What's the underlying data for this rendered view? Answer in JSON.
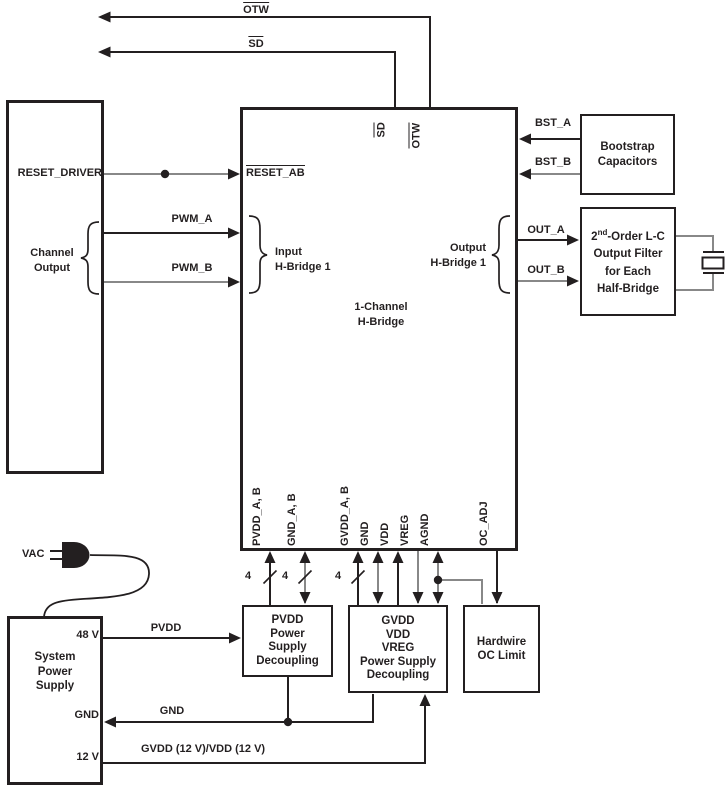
{
  "signals": {
    "otw": "OTW",
    "sd": "SD",
    "reset_driver": "RESET_DRIVER",
    "reset_ab": "RESET_AB",
    "pwm_a": "PWM_A",
    "pwm_b": "PWM_B",
    "bst_a": "BST_A",
    "bst_b": "BST_B",
    "out_a": "OUT_A",
    "out_b": "OUT_B",
    "pvdd_rail": "PVDD",
    "gnd_rail": "GND",
    "gvdd_rail": "GVDD (12 V)/VDD (12 V)",
    "vac": "VAC",
    "bus_width": "4"
  },
  "left_box": {
    "group_label": [
      "Channel",
      "Output"
    ]
  },
  "main_box": {
    "title": [
      "1-Channel",
      "H-Bridge"
    ],
    "pin_sd": "SD",
    "pin_otw": "OTW",
    "input_group": [
      "Input",
      "H-Bridge 1"
    ],
    "output_group": [
      "Output",
      "H-Bridge 1"
    ],
    "bottom_pins": [
      "PVDD_A, B",
      "GND_A, B",
      "GVDD_A, B",
      "GND",
      "VDD",
      "VREG",
      "AGND",
      "OC_ADJ"
    ]
  },
  "bootstrap_box": {
    "lines": [
      "Bootstrap",
      "Capacitors"
    ]
  },
  "filter_box": {
    "line1_base": "2",
    "line1_sup": "nd",
    "line1_rest": "-Order L-C",
    "line2": "Output Filter",
    "line3": "for Each",
    "line4": "Half-Bridge"
  },
  "pvdd_box": {
    "lines": [
      "PVDD",
      "Power",
      "Supply",
      "Decoupling"
    ]
  },
  "gvdd_box": {
    "lines": [
      "GVDD",
      "VDD",
      "VREG",
      "Power Supply",
      "Decoupling"
    ]
  },
  "oc_box": {
    "lines": [
      "Hardwire",
      "OC Limit"
    ]
  },
  "sps_box": {
    "lines": [
      "System",
      "Power",
      "Supply"
    ],
    "port_48v": "48 V",
    "port_gnd": "GND",
    "port_12v": "12 V"
  },
  "colors": {
    "wire_black": "#231f20",
    "wire_gray": "#888888"
  }
}
